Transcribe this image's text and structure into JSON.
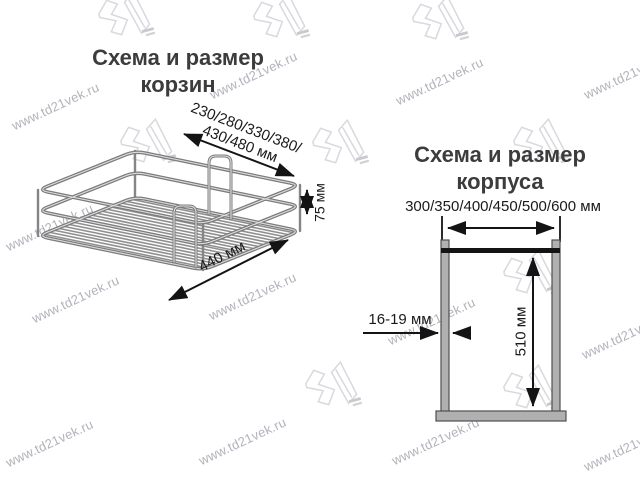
{
  "watermarks": {
    "site": "www.td21vek.ru"
  },
  "basket_section": {
    "title_line1": "Схема и размер",
    "title_line2": "корзин",
    "width_dim_line1": "230/280/330/380/",
    "width_dim_line2": "430/480 мм",
    "height_dim": "75 мм",
    "depth_dim": "440 мм"
  },
  "cabinet_section": {
    "title_line1": "Схема и размер",
    "title_line2": "корпуса",
    "width_dim": "300/350/400/450/500/600 мм",
    "height_dim": "510 мм",
    "wall_thickness_dim": "16-19 мм"
  }
}
